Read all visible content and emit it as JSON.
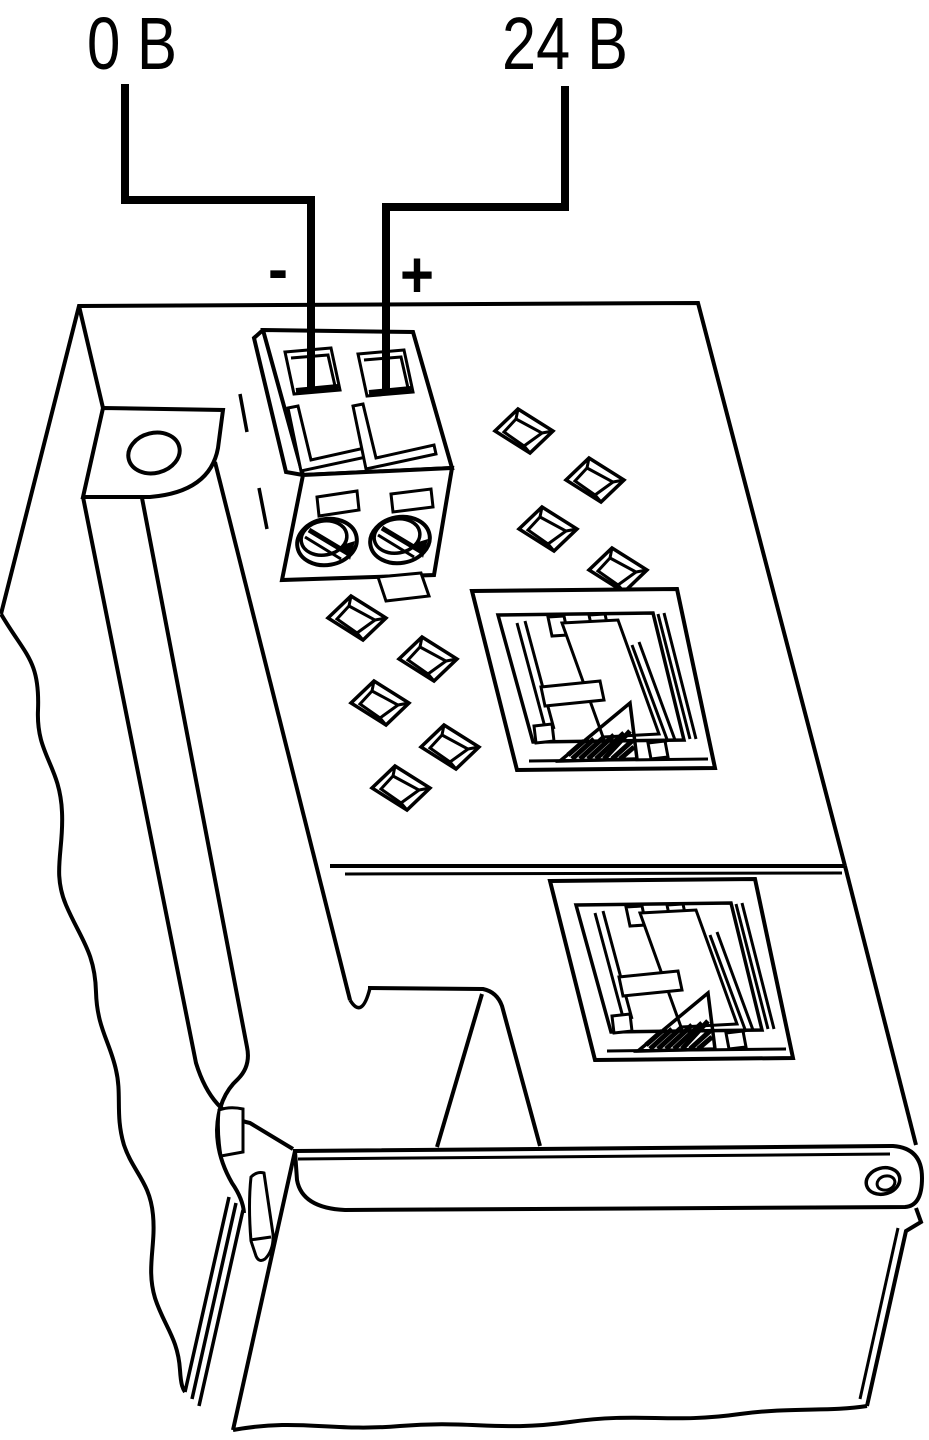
{
  "drawing": {
    "background_color": "#ffffff",
    "line_color": "#000000",
    "labels": {
      "left_wire_voltage": "0 В",
      "right_wire_voltage": "24 В",
      "negative_terminal": "-",
      "positive_terminal": "+"
    },
    "components": {
      "left_wire": "0V-supply-wire",
      "right_wire": "24V-supply-wire",
      "terminal_block": "two-pin-screw-terminal",
      "upper_port": "rj45-port",
      "lower_port": "rj45-port",
      "vent_holes_count": 9,
      "flange": "mounting-flange-oval-hole",
      "front_panel": "front-panel-strip-with-screw",
      "clip": "din-rail-clip",
      "break_lines": "wavy-cutaway-edges"
    }
  }
}
